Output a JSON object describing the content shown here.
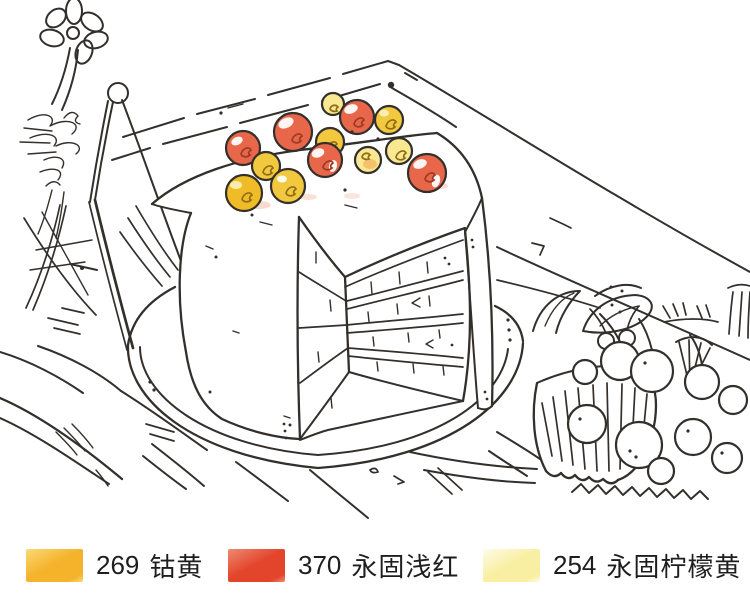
{
  "artwork": {
    "kind": "watercolor-line-sketch",
    "subject": "Hand-drawn pen sketch of a layered cake with a slice cut out, topped with red and yellow cherries, standing on a round cake plate on a wooden table; a paper cup full of cherries and leaves at lower right, a daisy flower with an easel sketch at upper left, a dish at lower left.",
    "ink": "#332f2b"
  },
  "fruit": {
    "red": "#E8664A",
    "yellow": "#F2C93E",
    "yellow_deep": "#EFBB27",
    "yellow_pale": "#F8E892",
    "orange": "#F3A94E",
    "red_mark": "#9C3A22",
    "yellow_mark": "#8F6D14",
    "shadow_pink": "#F4BCA4",
    "highlight": "#FFFFFF",
    "highlight_yellow": "#FDF4C4"
  },
  "legend": {
    "text_color": "#1e1e1e",
    "items": [
      {
        "code": "269",
        "name": "钴黄",
        "color": "#F4B32B",
        "color_light": "#FAD976"
      },
      {
        "code": "370",
        "name": "永固浅红",
        "color": "#E2452C",
        "color_light": "#EF8A70"
      },
      {
        "code": "254",
        "name": "永固柠檬黄",
        "color": "#F9EFA3",
        "color_light": "#FEFCE8"
      }
    ]
  }
}
